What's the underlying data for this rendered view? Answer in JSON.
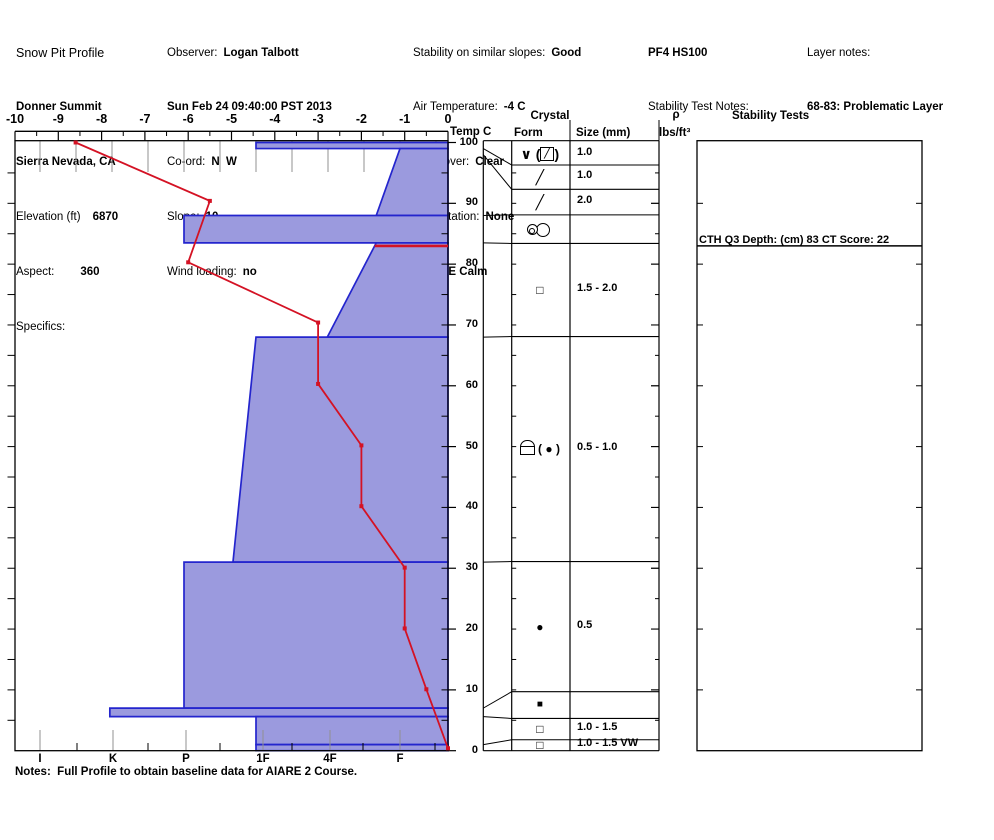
{
  "header": {
    "col1": {
      "title": "Snow Pit Profile",
      "site": "Donner Summit",
      "region": "Sierra Nevada, CA",
      "elevation_label": "Elevation (ft)",
      "elevation_value": "6870",
      "aspect_label": "Aspect:",
      "aspect_value": "360",
      "specifics_label": "Specifics:"
    },
    "col2": {
      "observer_label": "Observer:",
      "observer_value": "Logan Talbott",
      "datetime": "Sun Feb 24 09:40:00 PST 2013",
      "coord_label": "Co-ord:",
      "coord_value": "N  W",
      "slope_label": "Slope:",
      "slope_value": "10",
      "wind_loading_label": "Wind loading:",
      "wind_loading_value": "no"
    },
    "col3": {
      "stability_label": "Stability on similar slopes:",
      "stability_value": "Good",
      "air_temp_label": "Air Temperature:",
      "air_temp_value": "-4 C",
      "sky_label": "Sky Cover:",
      "sky_value": "Clear",
      "precip_label": "Precipitation:",
      "precip_value": "None",
      "wind_label": "Wind:",
      "wind_value": "E Calm"
    },
    "col4": {
      "pit_id": "PF4 HS100",
      "test_notes_label": "Stability Test Notes:"
    },
    "col5": {
      "layer_notes_label": "Layer notes:",
      "layer_notes_value": "68-83: Problematic Layer"
    }
  },
  "panel_headers": {
    "temp": "Temp C",
    "crystal": "Crystal",
    "form": "Form",
    "size": "Size (mm)",
    "rho": "ρ",
    "rho_units": "lbs/ft³",
    "stability_tests": "Stability Tests"
  },
  "stability_result": "CTH Q3 Depth: (cm) 83 CT Score: 22",
  "notes": "Notes:  Full Profile to obtain baseline data for AIARE 2 Course.",
  "chart_data": {
    "type": "area",
    "title": "Snow Pit Profile",
    "temp_axis": {
      "label": "Temp C",
      "min": -10,
      "max": 0,
      "major_ticks": [
        -10,
        -9,
        -8,
        -7,
        -6,
        -5,
        -4,
        -3,
        -2,
        -1,
        0
      ],
      "minor_step": 0.5
    },
    "depth_axis": {
      "min": 0,
      "max": 100,
      "tick_step": 10,
      "unit": "cm"
    },
    "hardness_axis": {
      "labels": [
        "I",
        "K",
        "P",
        "1F",
        "4F",
        "F"
      ]
    },
    "snow_height_cm": 100,
    "layers": [
      {
        "from": 100,
        "to": 99,
        "hardness": "1F",
        "h_top": 3,
        "h_bot": 3
      },
      {
        "from": 99,
        "to": 88,
        "hardness": "F to F+",
        "h_top": 5,
        "h_bot": 4.67
      },
      {
        "from": 88,
        "to": 83.5,
        "hardness": "P",
        "h_top": 2,
        "h_bot": 2
      },
      {
        "from": 83.5,
        "to": 68,
        "hardness": "F+ to 4F",
        "h_top": 4.67,
        "h_bot": 3.99
      },
      {
        "from": 68,
        "to": 31,
        "hardness": "1F to 1F+",
        "h_top": 3,
        "h_bot": 2.68
      },
      {
        "from": 31,
        "to": 7,
        "hardness": "P",
        "h_top": 2,
        "h_bot": 2
      },
      {
        "from": 7,
        "to": 5.6,
        "hardness": "K",
        "h_top": 0.97,
        "h_bot": 0.97
      },
      {
        "from": 5.6,
        "to": 1,
        "hardness": "1F",
        "h_top": 3,
        "h_bot": 3
      },
      {
        "from": 1,
        "to": 0,
        "hardness": "1F",
        "h_top": 3,
        "h_bot": 3
      }
    ],
    "temperature_profile": [
      {
        "t": -8.6,
        "d": 100
      },
      {
        "t": -5.5,
        "d": 90.4
      },
      {
        "t": -6.0,
        "d": 80.3
      },
      {
        "t": -3.0,
        "d": 70.4
      },
      {
        "t": -3.0,
        "d": 60.3
      },
      {
        "t": -2.0,
        "d": 50.2
      },
      {
        "t": -2.0,
        "d": 40.2
      },
      {
        "t": -1.0,
        "d": 30.1
      },
      {
        "t": -1.0,
        "d": 20.1
      },
      {
        "t": -0.5,
        "d": 10.1
      },
      {
        "t": 0,
        "d": 0.4
      }
    ],
    "failure_depth_cm": 83,
    "colors": {
      "layer_fill": "#9b9ade",
      "layer_border": "#2425cd",
      "temp_line": "#d41224",
      "grid_gray": "#909090"
    }
  },
  "crystal_table": {
    "rows": [
      {
        "from": 100,
        "to": 99,
        "row_from": 100,
        "row_to": 96.3,
        "form": "∨(╱)",
        "icon": "surface-hoar-boxed-slash",
        "form_pre": "∨ (",
        "form_boxed": "╱",
        "form_post": ")",
        "size": "1.0"
      },
      {
        "from": 99,
        "to": 98,
        "row_from": 96.3,
        "row_to": 92.3,
        "form": "╱",
        "size": "1.0"
      },
      {
        "from": 98,
        "to": 88,
        "row_from": 92.3,
        "row_to": 88.1,
        "form": "╱",
        "size": "2.0"
      },
      {
        "from": 88,
        "to": 83.5,
        "row_from": 88.1,
        "row_to": 83.4,
        "form": "◎○",
        "icon": "grain-cluster",
        "size": ""
      },
      {
        "from": 83.5,
        "to": 68,
        "row_from": 83.4,
        "row_to": 68.1,
        "form": "□",
        "size": "1.5 - 2.0"
      },
      {
        "from": 68,
        "to": 31,
        "row_from": 68.1,
        "row_to": 31.1,
        "form": "⊟( ● )",
        "icon": "crust-paren-circle",
        "form_post": "( ● )",
        "size": "0.5 - 1.0"
      },
      {
        "from": 31,
        "to": 7,
        "row_from": 31.1,
        "row_to": 9.7,
        "form": "●",
        "size": "0.5"
      },
      {
        "from": 7,
        "to": 5.6,
        "row_from": 9.7,
        "row_to": 5.3,
        "form": "■",
        "size": ""
      },
      {
        "from": 5.6,
        "to": 1,
        "row_from": 5.3,
        "row_to": 1.8,
        "form": "□",
        "size": "1.0 - 1.5"
      },
      {
        "from": 1,
        "to": 0,
        "row_from": 1.8,
        "row_to": 0,
        "form": "□",
        "size": "1.0 - 1.5 VW"
      }
    ]
  },
  "icons": {
    "row1_form": "boxed-slash-icon",
    "row4_form": "grain-cluster-icon",
    "row6_form": "melt-freeze-crust-icon"
  }
}
